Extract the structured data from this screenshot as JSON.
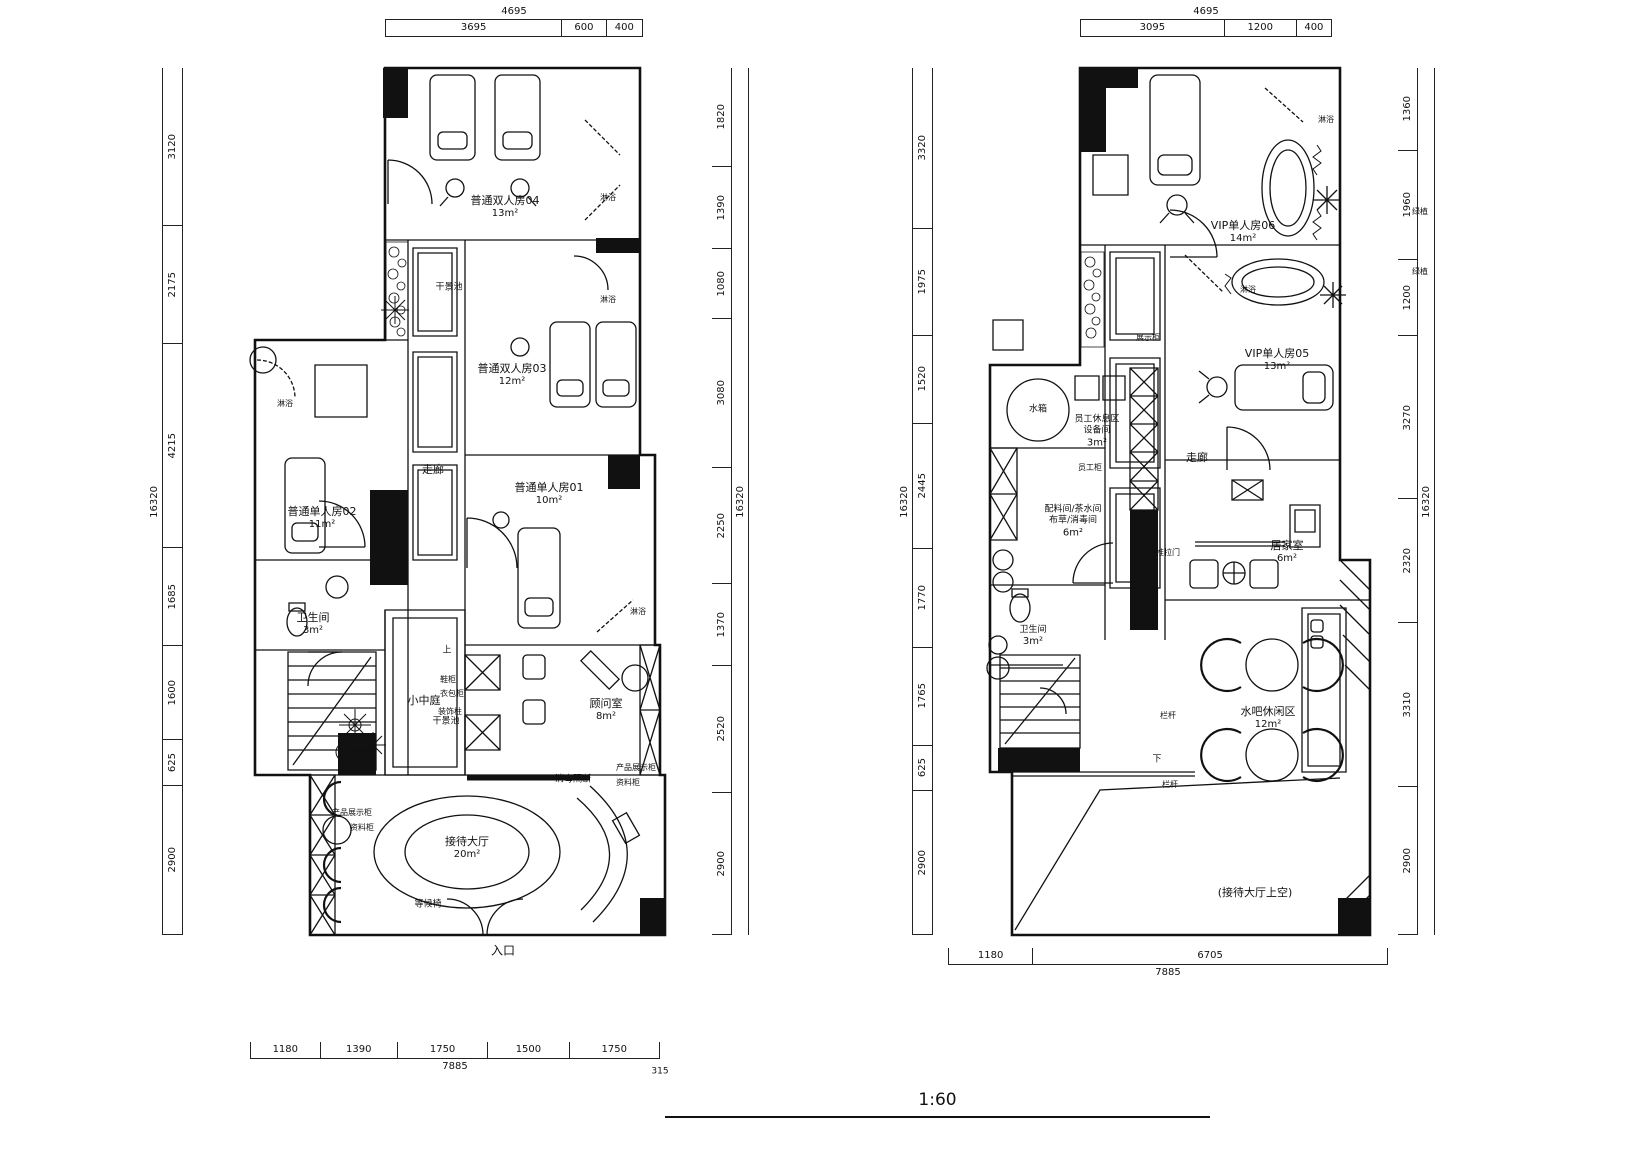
{
  "scale_label": "1:60",
  "plan1": {
    "dim_top_total": "4695",
    "dim_top": [
      "3695",
      "600",
      "400"
    ],
    "dim_left_total": "16320",
    "dim_left": [
      "3120",
      "2175",
      "4215",
      "1685",
      "1600",
      "625",
      "2900"
    ],
    "dim_right_total": "16320",
    "dim_right": [
      "1820",
      "1390",
      "1080",
      "3080",
      "2250",
      "1370",
      "2520",
      "2900"
    ],
    "dim_bottom": [
      "1180",
      "1390",
      "1750",
      "1500",
      "1750"
    ],
    "dim_bottom_total": "7885",
    "dim_bottom_extra": "315",
    "rooms": [
      {
        "name": "普通双人房04",
        "area": "13m²"
      },
      {
        "name": "普通双人房03",
        "area": "12m²"
      },
      {
        "name": "普通单人房02",
        "area": "11m²"
      },
      {
        "name": "普通单人房01",
        "area": "10m²"
      },
      {
        "name": "卫生间",
        "area": "3m²"
      },
      {
        "name": "小中庭",
        "area": ""
      },
      {
        "name": "顾问室",
        "area": "8m²"
      },
      {
        "name": "接待大厅",
        "area": "20m²"
      }
    ],
    "annotations": {
      "corridor": "走廊",
      "dry_pool": "干景池",
      "shower": "淋浴",
      "waiting_chair": "等候椅",
      "display_cabinet": "产品展示柜",
      "file_cabinet": "资料柜",
      "partition": "消毒隔断",
      "shoe_cabinet": "鞋柜",
      "bag_cabinet": "衣包柜",
      "deco_column": "装饰柱",
      "stair_up": "上",
      "entrance": "入口"
    }
  },
  "plan2": {
    "dim_top_total": "4695",
    "dim_top": [
      "3095",
      "1200",
      "400"
    ],
    "dim_left_total": "16320",
    "dim_left": [
      "3320",
      "1975",
      "1520",
      "2445",
      "1770",
      "1765",
      "625",
      "2900"
    ],
    "dim_right_total": "16320",
    "dim_right": [
      "1360",
      "1960",
      "1200",
      "3270",
      "2320",
      "3310",
      "2900"
    ],
    "dim_bottom": [
      "1180",
      "6705"
    ],
    "dim_bottom_total": "7885",
    "rooms": [
      {
        "name": "VIP单人房06",
        "area": "14m²"
      },
      {
        "name": "VIP单人房05",
        "area": "13m²"
      },
      {
        "name": "员工休息区",
        "name2": "设备间",
        "area": "3m²"
      },
      {
        "name": "配料间/茶水间",
        "name2": "布草/消毒间",
        "area": "6m²"
      },
      {
        "name": "卫生间",
        "area": "3m²"
      },
      {
        "name": "居家室",
        "area": "6m²"
      },
      {
        "name": "水吧休闲区",
        "area": "12m²"
      },
      {
        "name": "(接待大厅上空)",
        "area": ""
      }
    ],
    "annotations": {
      "corridor": "走廊",
      "water_tank": "水箱",
      "staff_cabinet": "员工柜",
      "display_cabinet": "展示柜",
      "sliding_door": "推拉门",
      "railing": "栏杆",
      "stair_down": "下",
      "shower": "淋浴",
      "plants": "绿植"
    }
  }
}
